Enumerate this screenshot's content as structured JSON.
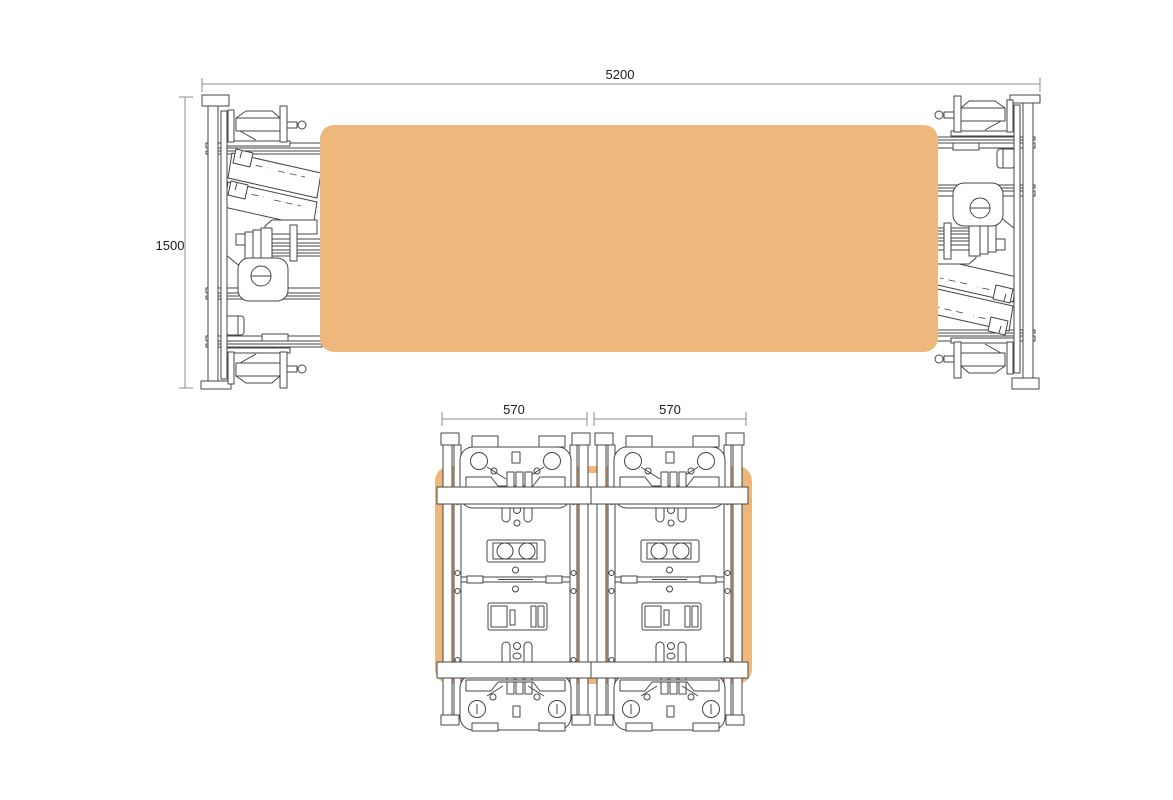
{
  "drawing": {
    "side_view": {
      "width_dim": "5200",
      "height_dim": "1500"
    },
    "end_view": {
      "module1_dim": "570",
      "module2_dim": "570"
    },
    "colors": {
      "panel": "#eeb87c",
      "line": "#454545",
      "dim_line": "#8f8f8f",
      "text": "#1c1c1c",
      "background": "#ffffff"
    }
  }
}
